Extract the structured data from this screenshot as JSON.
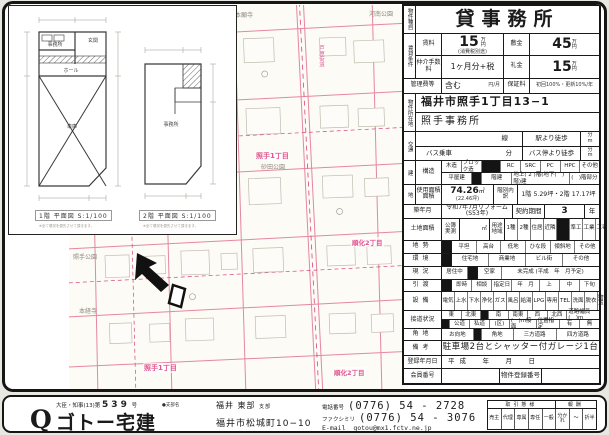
{
  "table": {
    "property_type_label": "物件種目",
    "title": "貸事務所",
    "rent_group_label": "賃貸条件",
    "rent_label": "賃料",
    "rent_value": "15",
    "rent_unit_top": "万",
    "rent_unit_bottom": "円",
    "rent_note": "(消費税別途)",
    "deposit_label": "敷金",
    "deposit_value": "45",
    "fee_label": "仲介手数料",
    "fee_value": "1ヶ月分+税",
    "key_money_label": "礼金",
    "key_money_value": "15",
    "mgmt_label": "管理費等",
    "mgmt_value": "含む",
    "mgmt_unit": "円/月",
    "guarantee_label": "保証料",
    "guarantee_value": "初回100%・更新10%/年",
    "address_label": "物件所在地",
    "address_line1": "福井市照手1丁目13−1",
    "address_line2": "照手事務所",
    "access_label": "交通",
    "access_line": "線",
    "access_walk": "駅より徒歩",
    "access_min": "分",
    "access_m": "m",
    "bus_ride": "バス乗車",
    "bus_min": "分",
    "bus_walk": "バス停より徒歩",
    "building_label": "建",
    "structure_label": "構造",
    "structure_opts": [
      "木造",
      "ブロック造",
      "鉄骨造",
      "RC",
      "SRC",
      "PC",
      "HPC",
      "その他"
    ],
    "floors_opt1": "平屋建",
    "floors_opt2": "階建",
    "floors_text": "地上( 2 )階(地下(　)階)建",
    "floors_part": "(　)階部分",
    "land_label": "地",
    "area_label1": "使用面積",
    "area_label2": "面積",
    "area_value": "74.26",
    "area_unit": "㎡",
    "area_tsubo": "(22.46坪)",
    "floor_breakdown_label": "階別内訳",
    "floor_breakdown_value": "1階 5.29坪・2階 17.17坪",
    "built_label": "築年月",
    "built_value": "令和7年7月リフォーム(S53年)",
    "contract_label": "契約期間",
    "contract_value": "3",
    "contract_unit": "年",
    "land_area_label": "土地面積",
    "kobo_label": "公簿",
    "jissoku_label": "実測",
    "m2": "㎡",
    "youto_label": "用途地域",
    "youto_opts": [
      "1種",
      "2種",
      "住居",
      "近隣",
      "商業",
      "準工",
      "工業",
      "工専",
      "市街化調整"
    ],
    "chisei_label": "地勢",
    "chisei_opts": [
      "平坦",
      "高台",
      "低地",
      "ひな段",
      "傾斜地",
      "その他"
    ],
    "env_label": "環境",
    "env_opts": [
      "住宅地",
      "商業地",
      "ビル街",
      "その他"
    ],
    "genkyo_label": "現況",
    "genkyo_opt1": "居住中",
    "genkyo_opt2": "空家",
    "genkyo_note": "未完成 (平成　年　月予定)",
    "hikiwatashi_label": "引渡",
    "hikiwatashi_opts": [
      "即時",
      "相談",
      "指定日"
    ],
    "hikiwatashi_date": "年　月",
    "hikiwatashi_jun": [
      "上",
      "中",
      "下旬"
    ],
    "setsubi_label": "設備",
    "setsubi_opts": [
      "電気",
      "上水",
      "下水",
      "浄化",
      "ガス",
      "風呂",
      "給湯",
      "LPG",
      "専用",
      "TEL",
      "洗面",
      "脱衣",
      "物置"
    ],
    "setsudo_label": "接道状況",
    "setsudo_dirs": [
      "東",
      "北東",
      "南",
      "南東",
      "西",
      "北西"
    ],
    "setsudo_width": "道路幅員(　)m",
    "setsudo_opts2": [
      "公道",
      "私道",
      "(区)",
      "(　)m接面",
      "位置指定",
      "有",
      "無"
    ],
    "kadochi_label": "角地",
    "kadochi_opts": [
      "お向地",
      "角地",
      "三方道路",
      "四方道路"
    ],
    "biko_label": "備考",
    "biko_value": "駐車場2台とシャッター付ガレージ1台",
    "reg_label": "登録年月日",
    "reg_value": "平成　年　月　日",
    "member_label": "会員番号",
    "property_reg_label": "物件登録番号"
  },
  "floorplan": {
    "caption1": "1階 平面図 S:1/100",
    "caption2": "2階 平面図 S:1/100",
    "note": "※全て現況を優先させて頂きます。",
    "room_office1": "事務所",
    "room_entrance": "玄関",
    "room_hall": "ホール",
    "room_garage": "車庫",
    "room_office2": "事務所"
  },
  "map": {
    "labels": {
      "temple_top": "本願寺",
      "park_kanan": "河南公園",
      "road_awara": "芦原街道",
      "town_terute1_mid": "照手1丁目",
      "park_sunada": "砂田公園",
      "town_junka_right": "順化2丁目",
      "park_terute": "照手公園",
      "temple_honkyoji": "本経寺",
      "town_terute1_bottom": "照手1丁目",
      "town_junka_bottom": "順化2丁目"
    }
  },
  "footer": {
    "license_prefix": "大臣・知事(13)第",
    "license_no": "539",
    "license_suffix": "号",
    "logo_q": "Q",
    "logo_text": "ゴトー宅建",
    "branch_bullet": "●支部名",
    "branch": "福井 東部",
    "branch_suffix": "支部",
    "address": "福井市松城町10−10",
    "tel_label": "電話番号",
    "tel": "(0776)  54 - 2728",
    "fax_label": "ファクシミリ",
    "fax": "(0776)  54 - 3076",
    "email_label": "E-mail",
    "email": "gotou@mx1.fctv.ne.jp",
    "deal": {
      "header_left": "取引態様",
      "header_right": "報酬",
      "cols": [
        "売主",
        "代理",
        "専属",
        "専任",
        "一般",
        "分かれ",
        "〜",
        "折半"
      ]
    }
  }
}
